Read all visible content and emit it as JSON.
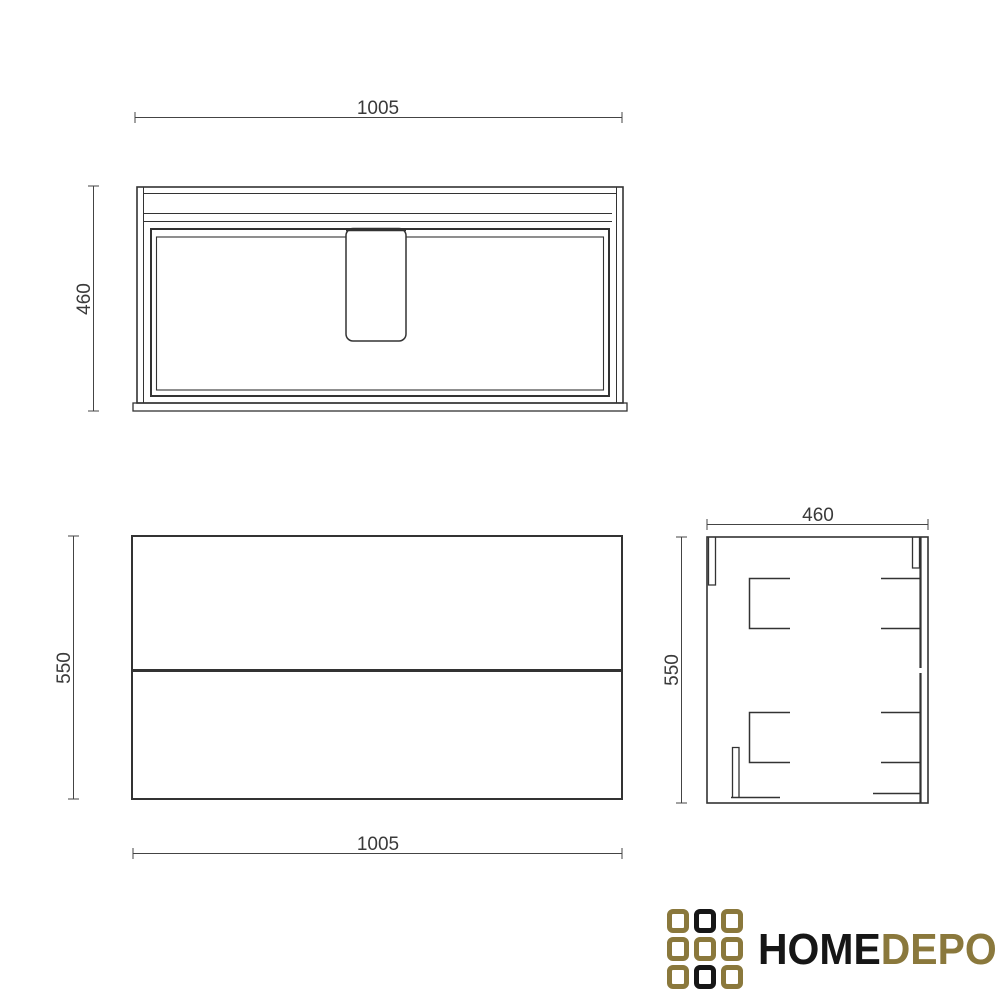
{
  "title": "Vanity cabinet technical drawing",
  "views": {
    "top": {
      "width_label": "1005",
      "depth_label": "460"
    },
    "front": {
      "width_label": "1005",
      "height_label": "550"
    },
    "side": {
      "depth_label": "460",
      "height_label": "550"
    }
  },
  "logo": {
    "text_primary": "HOME",
    "text_secondary": "DEPO",
    "colors": {
      "gold": "#8a783c",
      "dark": "#161616"
    },
    "grid": {
      "rows": 3,
      "cols": 3,
      "pattern": [
        "gold",
        "black",
        "gold",
        "gold",
        "gold",
        "gold",
        "gold",
        "black",
        "gold"
      ]
    }
  },
  "style": {
    "background": "#ffffff",
    "line_color": "#333333",
    "dim_text_color": "#3a3a3a"
  }
}
